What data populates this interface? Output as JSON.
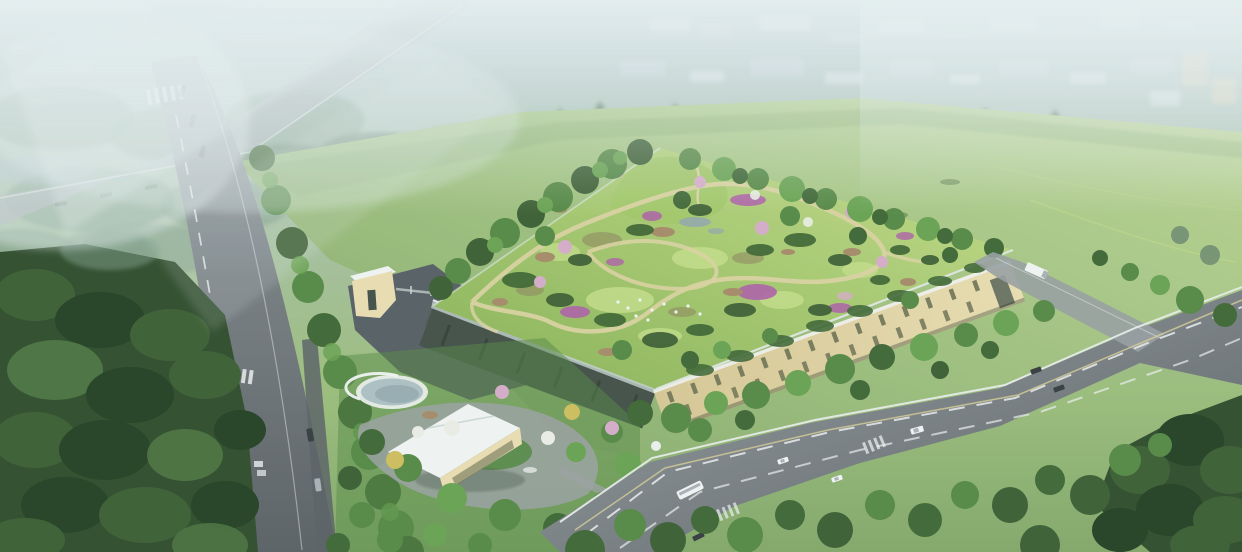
{
  "image": {
    "kind": "aerial architectural rendering",
    "subject": "green-roof civic building with a landscaped rooftop garden (winding paths, lawns, purple flower beds), gated plaza and entrance pavilion, bounded by a tree-lined avenue on the left, a wide arterial road at the lower right, dense forest at lower left, open meadow at upper right, and a foggy industrial skyline with an elevated road crossing at the top",
    "visible_text": "none"
  },
  "features": [
    "foggy sky band with faint factory blocks",
    "distant conifer row and tree line",
    "elevated road crossing in mist (top left)",
    "avenue running down the left with dashed lane line and crosswalks",
    "dense dark forest lower-left",
    "hedgerow of trees along the avenue",
    "large meadow sweeping to the right",
    "rooftop garden with looping tan paths, lawns, shrubs, rocks, purple and pink planting, tiny white sheep figures",
    "cream building facade with two rows of slit windows",
    "dark glazed west wing with white parapet rail",
    "gray entry plaza with gatehouse and fence",
    "white-roofed entrance pavilion and circular pond with deck",
    "arterial road with lane markings, bus, cars and a white shuttle on the site driveway",
    "street trees and forest at lower right",
    "soft fog overlays and light beams"
  ],
  "colors": {
    "sky_top": "#b2c5cc",
    "fog": "#c3d2d6",
    "haze": "#e9f1f2",
    "mist_green": "#a9c0a6",
    "city_light": "#d4dde0",
    "city_mid": "#c1cdd2",
    "city_tan": "#d8cfb6",
    "mist_tree": "#7f9d89",
    "conifer": "#54755e",
    "treeline": "#66836b",
    "water_far": "#a7bcc2",
    "field_light": "#bdd593",
    "field_mid": "#9cbe7b",
    "field_dark": "#83a768",
    "road_far": "#a9b1b5",
    "road_light": "#989ea1",
    "road_mid": "#767c80",
    "road_dark": "#595f63",
    "lane_white": "#edefef",
    "lane_yellow": "#d8ce95",
    "mark_dark": "#3b4144",
    "forest_base": "#2e4b2a",
    "forest_dark": "#223e21",
    "forest_mid": "#3b5d31",
    "forest_light": "#4e7540",
    "tree_bright": "#68a24f",
    "tree_mid": "#548742",
    "tree_deep": "#3e6532",
    "tree_yellow": "#cfbe5b",
    "blossom_white": "#ecefe6",
    "blossom_pink": "#d7adc8",
    "blossom_purple": "#af5ea7",
    "lawn_light": "#c4dd87",
    "lawn_mid": "#a2c767",
    "lawn_dark": "#88b254",
    "path_tan": "#dbd3a0",
    "rock_tan": "#a68b68",
    "soil": "#8b7b59",
    "facade_cream": "#ebdeb1",
    "facade_cream_dark": "#d8c793",
    "facade_shade": "#424e45",
    "window_dark": "#6d7051",
    "parapet_light": "#e0e8e3",
    "glass": "#c6d2cf",
    "plaza": "#565d61",
    "plaza_light": "#9ba1a1",
    "white": "#f3f5f4",
    "pond": "#aec0c3",
    "pond_deep": "#92a7ae",
    "vehicle_dark": "#353a3d",
    "shadow": "#233023"
  }
}
